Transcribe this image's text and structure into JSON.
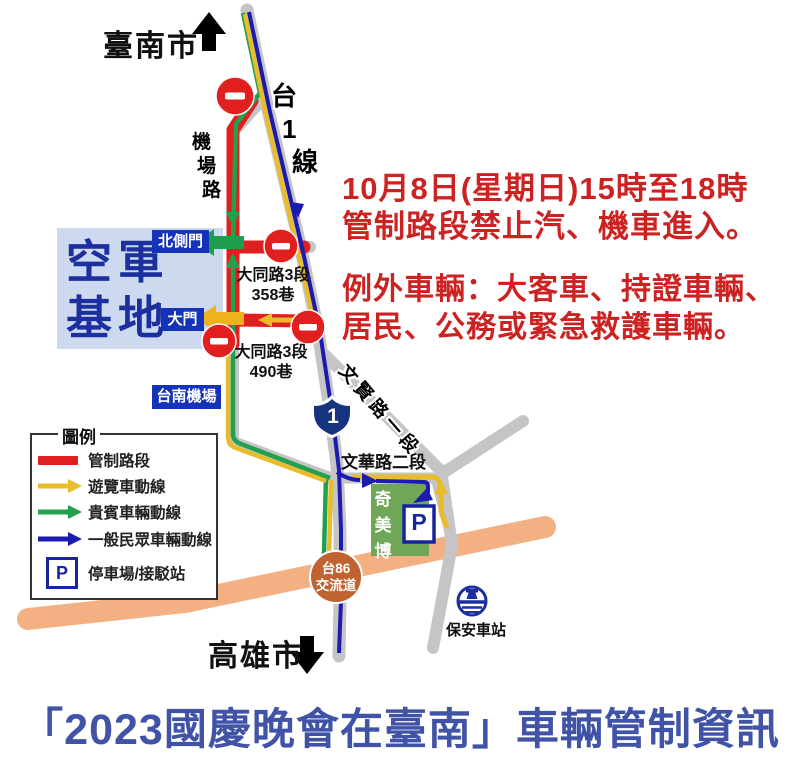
{
  "map_title": "「2023國慶晚會在臺南」車輛管制資訊",
  "notice": {
    "l1": "10月8日(星期日)15時至18時",
    "l2": "管制路段禁止汽、機車進入。",
    "l3": "例外車輛：大客車、持證車輛、",
    "l4": "居民、公務或緊急救護車輛。"
  },
  "directions": {
    "north": "臺南市",
    "south": "高雄市"
  },
  "roads": {
    "highway1_label": "台1線",
    "airport_road": "機場路",
    "lane358_l1": "大同路3段",
    "lane358_l2": "358巷",
    "lane490_l1": "大同路3段",
    "lane490_l2": "490巷",
    "wenxian": "文賢路一段",
    "wenhua": "文華路二段",
    "shield_number": "1",
    "interchange_l1": "台86",
    "interchange_l2": "交流道"
  },
  "places": {
    "airbase_l1": "空軍",
    "airbase_l2": "基地",
    "north_gate": "北側門",
    "main_gate": "大門",
    "airport": "台南機場",
    "museum": "奇美博",
    "parking_mark": "P",
    "station": "保安車站"
  },
  "legend": {
    "title": "圖例",
    "control": "管制路段",
    "bus": "遊覽車動線",
    "vip": "貴賓車輛動線",
    "public": "一般民眾車輛動線",
    "parking": "停車場/接駁站",
    "parking_mark": "P"
  },
  "colors": {
    "control_red": "#e02020",
    "bus_yellow": "#e8bc2a",
    "vip_green": "#21a04e",
    "public_blue": "#1b1bb0",
    "road_gray": "#c5c5c5",
    "expressway_orange": "#f3b183",
    "notice_red": "#cc2222",
    "title_blue": "#4053a7"
  }
}
